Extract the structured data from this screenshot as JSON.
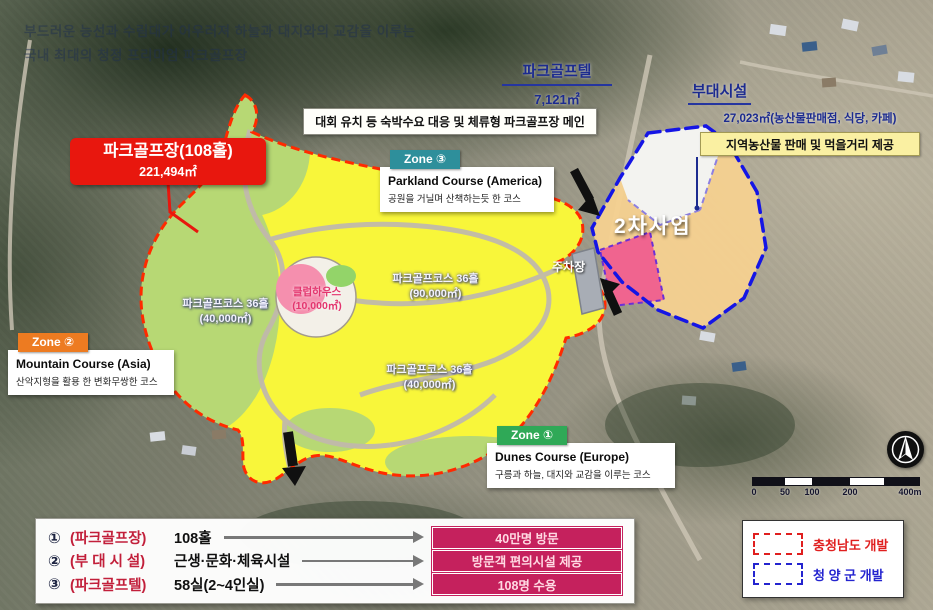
{
  "title_watermark": {
    "line1": "부드러운 능선과 수림대가 어우러져 하늘과 대지와의 교감을 이루는",
    "line2": "국내 최대의 청정 프리미엄 파크골프장"
  },
  "golftel": {
    "name": "파크골프텔",
    "area": "7,121㎡",
    "note": "대회 유치 등 숙박수요 대응 및 체류형 파크골프장 메인"
  },
  "annex": {
    "name": "부대시설",
    "area": "27,023㎡(농산물판매점, 식당, 카페)",
    "note": "지역농산물 판매 및 먹을거리 제공"
  },
  "main_course": {
    "name": "파크골프장(108홀)",
    "area": "221,494㎡"
  },
  "zones": [
    {
      "tag": "Zone ③",
      "name": "Parkland Course (America)",
      "desc": "공원을 거닐며 산책하는듯 한 코스",
      "color": "#2e8f9b"
    },
    {
      "tag": "Zone ②",
      "name": "Mountain Course (Asia)",
      "desc": "산악지형을 활용 한 변화무쌍한 코스",
      "color": "#ed7b21"
    },
    {
      "tag": "Zone ①",
      "name": "Dunes Course (Europe)",
      "desc": "구릉과 하늘, 대지와 교감을 이루는 코스",
      "color": "#2fa957"
    }
  ],
  "map_labels": {
    "course_west": {
      "name": "파크골프코스 36홀",
      "area": "(40,000㎡)"
    },
    "course_center": {
      "name": "파크골프코스 36홀",
      "area": "(90,000㎡)"
    },
    "course_south": {
      "name": "파크골프코스 36홀",
      "area": "(40,000㎡)"
    },
    "clubhouse": {
      "name": "클럽하우스",
      "area": "(10,000㎡)"
    },
    "parking": "주차장",
    "phase2": "2차사업"
  },
  "summary": {
    "rows": [
      {
        "num": "①",
        "name": "(파크골프장)",
        "value": "108홀",
        "result": "40만명 방문"
      },
      {
        "num": "②",
        "name": "(부 대 시 설)",
        "value": "근생·문화·체육시설",
        "result": "방문객 편의시설 제공"
      },
      {
        "num": "③",
        "name": "(파크골프텔)",
        "value": "58실(2~4인실)",
        "result": "108명 수용"
      }
    ]
  },
  "legend": {
    "items": [
      {
        "label": "충청남도 개발",
        "color": "#e01f1f"
      },
      {
        "label": "청 양 군 개발",
        "color": "#2424cf"
      }
    ]
  },
  "scalebar": {
    "ticks": [
      "0",
      "50",
      "100",
      "200",
      "400m"
    ]
  },
  "colors": {
    "site_fill": "#f8f63a",
    "site_green": "#b7d874",
    "site_border": "#ff2a00",
    "phase2_border": "#1515e5",
    "badge_bg": "#c5215d"
  }
}
